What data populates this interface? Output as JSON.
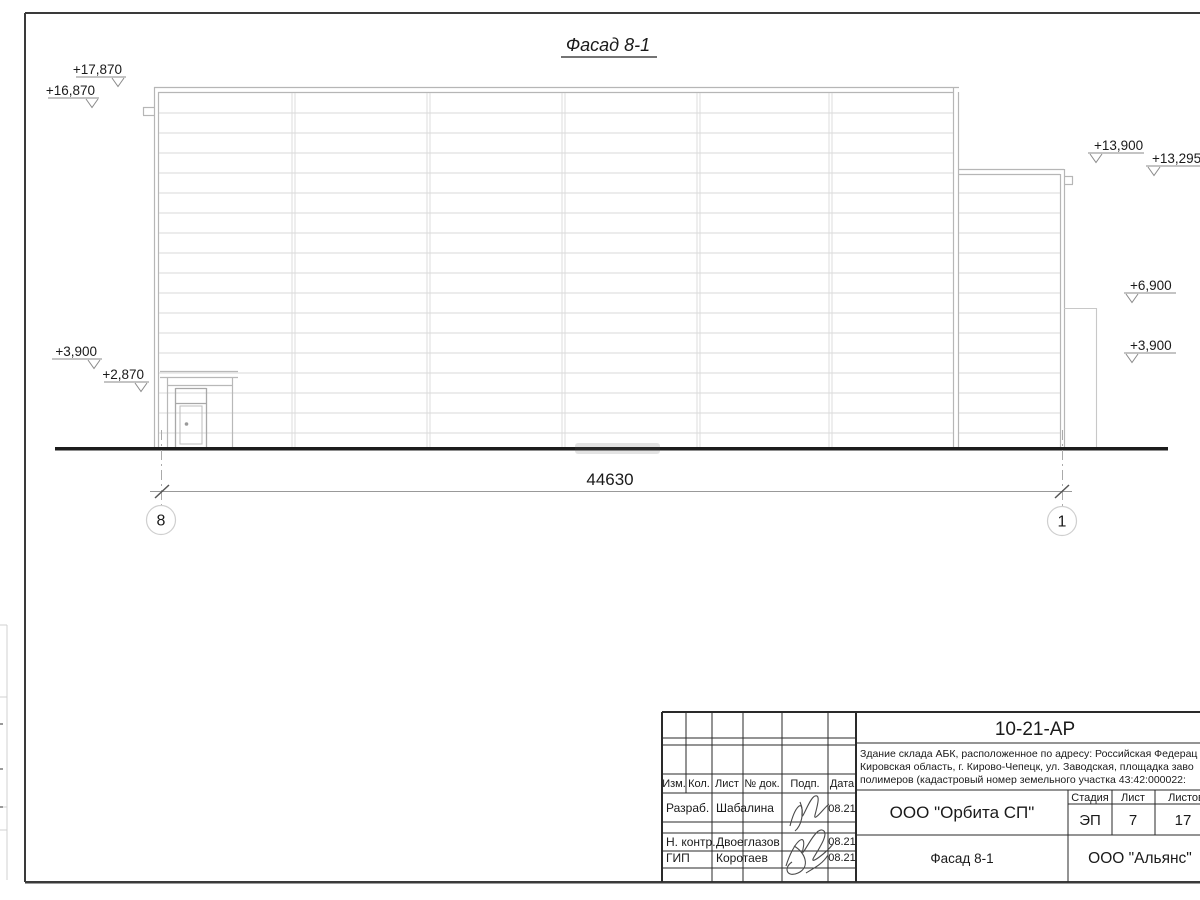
{
  "drawing": {
    "title": "Фасад 8-1",
    "dimension": "44630",
    "axis_left": "8",
    "axis_right": "1",
    "elevations": [
      "+17,870",
      "+16,870",
      "+13,900",
      "+13,295",
      "+6,900",
      "+3,900",
      "+3,900",
      "+2,870"
    ]
  },
  "titleblock": {
    "doc_number": "10-21-АР",
    "description_lines": [
      "Здание склада АБК, расположенное по адресу: Российская Федерац",
      "Кировская область, г. Кирово-Чепецк, ул. Заводская, площадка заво",
      "полимеров (кадастровый номер земельного участка 43:42:000022:"
    ],
    "header_cols": {
      "izm": "Изм.",
      "kol": "Кол.",
      "list": "Лист",
      "ndok": "№ док.",
      "podp": "Подп.",
      "data": "Дата"
    },
    "roles": [
      {
        "role": "Разраб.",
        "name": "Шабалина",
        "date": "08.21"
      },
      {
        "role": "Н. контр.",
        "name": "Двоеглазов",
        "date": "08.21"
      },
      {
        "role": "ГИП",
        "name": "Коротаев",
        "date": "08.21"
      }
    ],
    "company": "ООО \"Орбита СП\"",
    "stage_label": "Стадия",
    "sheet_label": "Лист",
    "sheets_label": "Листов",
    "stage": "ЭП",
    "sheet": "7",
    "sheets": "17",
    "sheet_title": "Фасад 8-1",
    "contractor": "ООО \"Альянс\""
  }
}
